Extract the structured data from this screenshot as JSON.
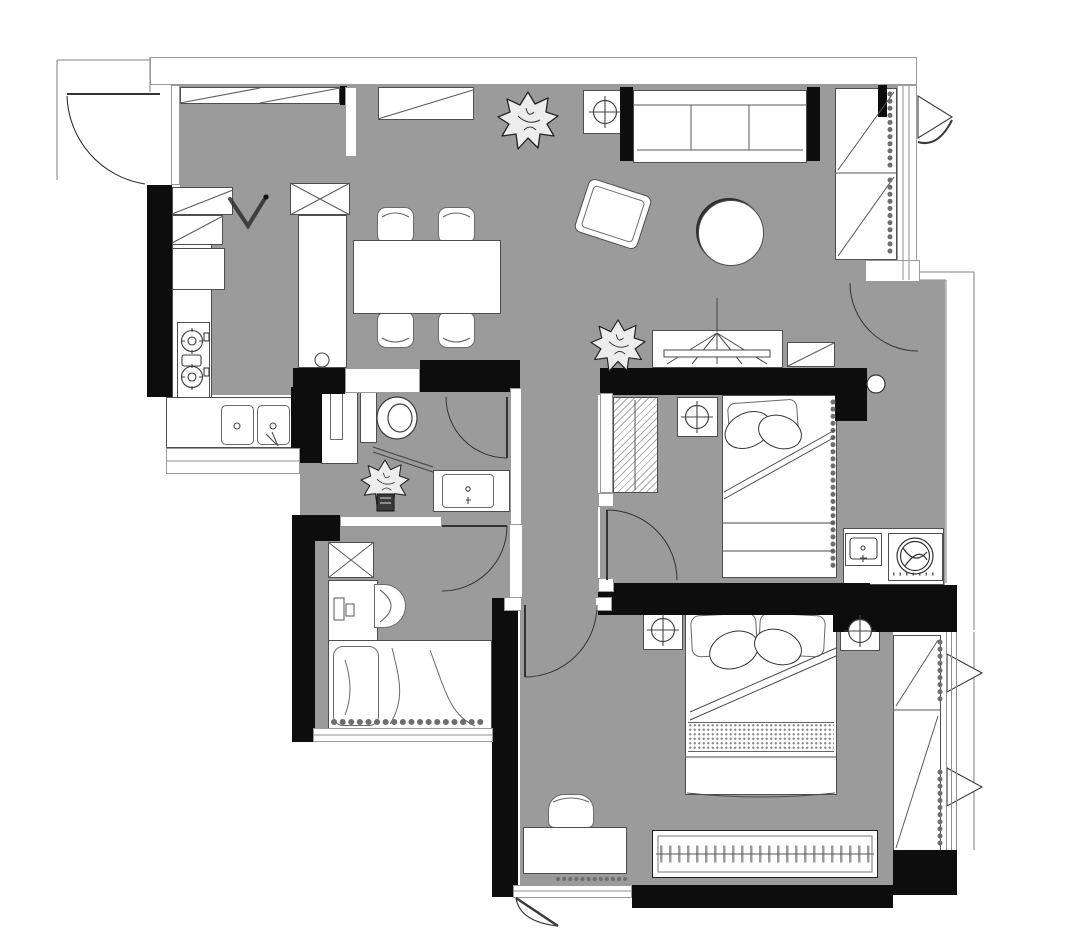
{
  "meta": {
    "title": "apartment-floor-plan",
    "canvas": {
      "width": 1080,
      "height": 950
    },
    "drawing_type": "architectural floor plan, top view, no text labels"
  },
  "palette": {
    "background": "#ffffff",
    "floor": "#9b9b9b",
    "wall": "#0d0d0d",
    "furniture_fill": "#ffffff",
    "furniture_line": "#4f4f4f",
    "thin_line": "#9a9a9a",
    "accent_dark": "#222222"
  },
  "rooms": [
    {
      "id": "living-dining",
      "label": "Living / Dining / Entry Area"
    },
    {
      "id": "laundry-corridor",
      "label": "Laundry Corridor"
    },
    {
      "id": "bathroom",
      "label": "Bathroom"
    },
    {
      "id": "study-bedroom",
      "label": "Study Bedroom"
    },
    {
      "id": "hallway",
      "label": "Hallway"
    },
    {
      "id": "secondary-bedroom",
      "label": "Secondary Bedroom"
    },
    {
      "id": "master-bedroom",
      "label": "Master Bedroom"
    }
  ],
  "furniture": {
    "entry": [
      "entrance-door",
      "shoe-closet",
      "coat-hook",
      "hall-cabinet"
    ],
    "kitchen": [
      "l-shaped-counter",
      "upper-cabinets",
      "two-burner-gas-stove",
      "double-bowl-sink",
      "refrigerator",
      "island-counter"
    ],
    "dining": [
      "dining-table",
      "dining-chair x4"
    ],
    "living": [
      "three-seat-sofa",
      "black-side-blocks",
      "lamp-side-table",
      "round-coffee-table",
      "rotated-armchair",
      "potted-plant x2",
      "bay-window-cabinet",
      "curtains",
      "casement-window"
    ],
    "bathroom": [
      "toilet",
      "glass-partition",
      "shower-plant",
      "storage-ledge",
      "vanity-sink",
      "swing-door"
    ],
    "study_bedroom": [
      "storage-cabinet",
      "desk",
      "desk-chair",
      "daybed-with-drape",
      "window-band"
    ],
    "secondary_bedroom": [
      "tv-console",
      "media-cabinet",
      "wardrobe",
      "nightstand-lamp",
      "single-bed",
      "swing-door"
    ],
    "laundry": [
      "utility-sink",
      "washing-machine",
      "counter"
    ],
    "master_bedroom": [
      "double-bed",
      "pillows x4",
      "nightstand-lamp x2",
      "dressing-table",
      "stool",
      "sliding-wardrobe",
      "balcony-cabinet",
      "curtains",
      "casement-windows",
      "swing-door"
    ]
  },
  "doors": [
    "entry-arc-door",
    "toilet-door",
    "study-door",
    "secondary-bedroom-door",
    "master-bedroom-door",
    "corridor-arc-door"
  ],
  "counts": {
    "bedrooms": 3,
    "bathrooms": 1,
    "plants": 3,
    "door-arcs": 6
  }
}
